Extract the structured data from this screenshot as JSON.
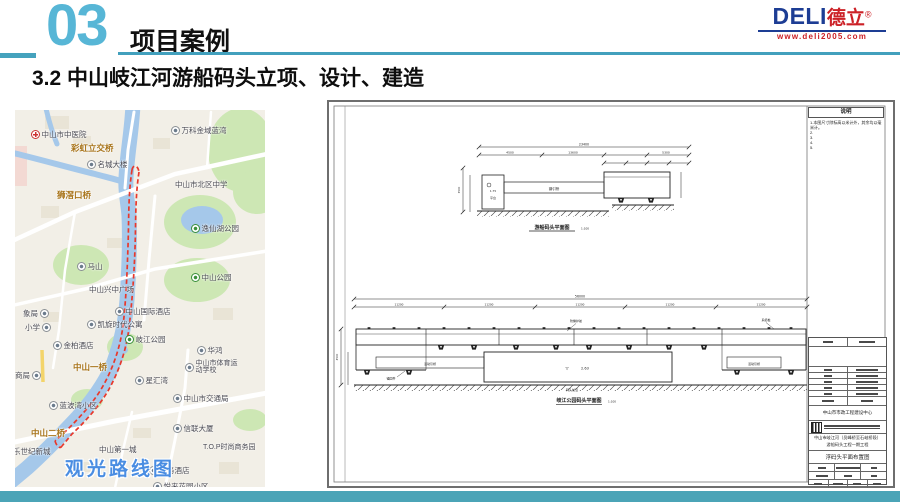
{
  "header": {
    "section_number": "03",
    "section_title": "项目案例",
    "logo": {
      "brand_latin": "DELI",
      "brand_cn": "德立",
      "registered": "®",
      "website": "www.deli2005.com"
    }
  },
  "slide": {
    "heading": "3.2  中山岐江河游船码头立项、设计、建造"
  },
  "map": {
    "caption": "观光路线图",
    "labels": [
      {
        "text": "中山市中医院",
        "type": "hospital"
      },
      {
        "text": "万科金域蓝湾",
        "type": "place"
      },
      {
        "text": "彩虹立交桥",
        "type": "bridge"
      },
      {
        "text": "名城大楼",
        "type": "place"
      },
      {
        "text": "中山市北区中学",
        "type": "school"
      },
      {
        "text": "狮滘口桥",
        "type": "bridge"
      },
      {
        "text": "逸仙湖公园",
        "type": "park"
      },
      {
        "text": "马山",
        "type": "mountain"
      },
      {
        "text": "中山公园",
        "type": "park"
      },
      {
        "text": "中山兴中广场",
        "type": "place"
      },
      {
        "text": "中山国际酒店",
        "type": "hotel"
      },
      {
        "text": "凯旋时代公寓",
        "type": "place"
      },
      {
        "text": "岐江公园",
        "type": "park"
      },
      {
        "text": "金柏酒店",
        "type": "hotel"
      },
      {
        "text": "华鸿",
        "type": "place"
      },
      {
        "text": "中山一桥",
        "type": "bridge"
      },
      {
        "text": "中山市体育运动学校",
        "type": "school"
      },
      {
        "text": "星汇湾",
        "type": "place"
      },
      {
        "text": "中山市交通局",
        "type": "gov"
      },
      {
        "text": "蓝波湾小区",
        "type": "place"
      },
      {
        "text": "信联大厦",
        "type": "place"
      },
      {
        "text": "中山二桥",
        "type": "bridge"
      },
      {
        "text": "乐世纪新城",
        "type": "place"
      },
      {
        "text": "中山第一城",
        "type": "place"
      },
      {
        "text": "T.O.P时尚商务园",
        "type": "place"
      },
      {
        "text": "商务酒店",
        "type": "hotel"
      },
      {
        "text": "悦来花园小区",
        "type": "place"
      },
      {
        "text": "象局",
        "type": "gov"
      },
      {
        "text": "小学",
        "type": "school"
      },
      {
        "text": "商局",
        "type": "gov"
      }
    ]
  },
  "drawing": {
    "notes": {
      "header": "说明",
      "line1": "1.本图尺寸除标高以米计外，其余均以毫米计。",
      "item2": "2.",
      "item3": "3.",
      "item4": "4.",
      "item5": "5."
    },
    "captions": {
      "top": "游船码头平面图",
      "top_scale": "1:100",
      "bottom": "岐江公园码头平面图",
      "bottom_scale": "1:100"
    },
    "labels": {
      "platform": "平台",
      "platform_elev": "1.75",
      "walkway": "钢引桥",
      "gangway_left": "活动引桥",
      "gangway_right": "活动引桥",
      "fender": "防撞护舷",
      "bollard": "系缆桩",
      "anchor": "锚固件",
      "apron": "码头前沿",
      "elevation_mark": "▽",
      "elevation": "2.63"
    },
    "dims": {
      "top_total": "23400",
      "top_seg1": "4500",
      "top_seg2": "13600",
      "top_seg3": "5300",
      "top_height": "3500",
      "bottom_total": "56000",
      "bottom_seg": "11200",
      "bottom_height": "4500"
    },
    "titleblock": {
      "client": "中山市市政工程建设中心",
      "project_line1": "中山市岐江河（员峰桥至石岐桥段）",
      "project_line2": "游船码头工程一期工程",
      "sheet_title": "浮码头平面布置图"
    }
  },
  "colors": {
    "accent_teal": "#45a3b8",
    "brand_blue": "#1d3d94",
    "brand_red": "#cc2127",
    "route_red": "#e8382b",
    "map_caption_blue": "#4a8de2"
  }
}
